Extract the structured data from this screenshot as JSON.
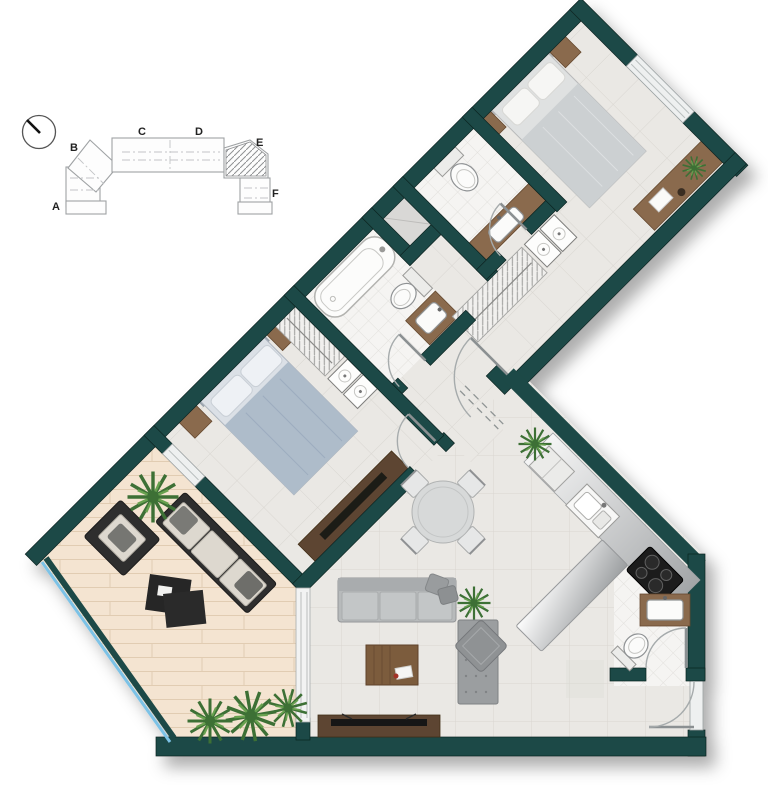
{
  "keyplan": {
    "units": [
      {
        "label": "A"
      },
      {
        "label": "B"
      },
      {
        "label": "C"
      },
      {
        "label": "D"
      },
      {
        "label": "E"
      },
      {
        "label": "F"
      }
    ],
    "highlighted_unit": "E"
  },
  "colors": {
    "wall": "#1d4a46",
    "wallEdge": "#0c2422",
    "floorTile": "#eae8e4",
    "floorLine": "#d9d6d1",
    "marble": "#f5f4f2",
    "marbleLine": "#e2e0dc",
    "deck": "#f4e4d1",
    "deckLine": "#e1ccb2",
    "wood": "#8a6a4e",
    "woodDark": "#5d4530",
    "railGlass": "#7cc2e6",
    "charcoal": "#2d2d2d",
    "sofaBack": "#a9acae",
    "sofaSeat": "#c3c6c7",
    "gray1": "#9b9ea0",
    "bedLinen": "#dfe1e1",
    "bed2Linen": "#aebcca",
    "plantDark": "#3c7036",
    "plantLight": "#67a14f",
    "counterLight": "#fdfdfd",
    "counterDark": "#9b9ea0",
    "fixtureStroke": "#8f9294",
    "doorArc": "#a6abac"
  },
  "icons": [
    "north-indicator-icon",
    "double-bed-icon",
    "nightstand-icon",
    "bathtub-icon",
    "toilet-icon",
    "washbasin-icon",
    "wardrobe-icon",
    "washing-machine-icon",
    "sofa-icon",
    "daybed-icon",
    "dining-table-icon",
    "dining-chair-icon",
    "kitchen-island-icon",
    "kitchen-counter-icon",
    "cooktop-icon",
    "kitchen-sink-icon",
    "fridge-icon",
    "tv-console-icon",
    "desk-icon",
    "plant-icon",
    "outdoor-sofa-icon",
    "outdoor-armchair-icon",
    "coffee-table-icon",
    "door-swing-icon",
    "sliding-door-icon",
    "window-icon",
    "glass-railing-icon",
    "shaft-icon"
  ]
}
